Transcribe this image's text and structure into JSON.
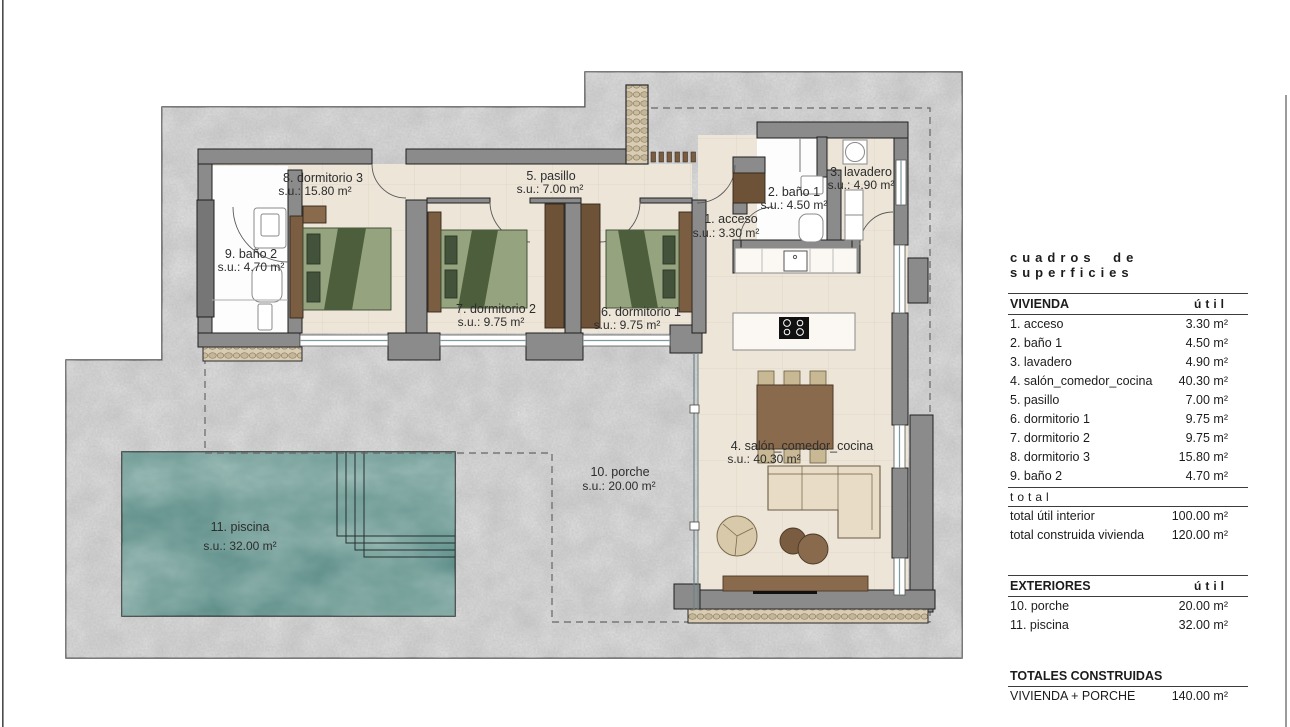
{
  "plan": {
    "labels": [
      {
        "id": "acceso",
        "l1": "1. acceso",
        "l2": "s.u.: 3.30 m²"
      },
      {
        "id": "bano1",
        "l1": "2. baño 1",
        "l2": "s.u.: 4.50 m²"
      },
      {
        "id": "lavadero",
        "l1": "3. lavadero",
        "l2": "s.u.: 4.90 m²"
      },
      {
        "id": "salon",
        "l1": "4. salón_comedor_cocina",
        "l2": "s.u.: 40.30 m²"
      },
      {
        "id": "pasillo",
        "l1": "5. pasillo",
        "l2": "s.u.: 7.00 m²"
      },
      {
        "id": "dormitorio1",
        "l1": "6. dormitorio 1",
        "l2": "s.u.: 9.75 m²"
      },
      {
        "id": "dormitorio2",
        "l1": "7. dormitorio 2",
        "l2": "s.u.: 9.75 m²"
      },
      {
        "id": "dormitorio3",
        "l1": "8. dormitorio 3",
        "l2": "s.u.: 15.80 m²"
      },
      {
        "id": "bano2",
        "l1": "9. baño 2",
        "l2": "s.u.: 4.70 m²"
      },
      {
        "id": "porche",
        "l1": "10. porche",
        "l2": "s.u.: 20.00 m²"
      },
      {
        "id": "piscina",
        "l1": "11. piscina",
        "l2": "s.u.: 32.00 m²"
      }
    ]
  },
  "panel": {
    "title": "cuadros de superficies",
    "vivienda": {
      "header": "VIVIENDA",
      "unit_col": "útil",
      "rows": [
        {
          "label": "1. acceso",
          "value": "3.30 m²"
        },
        {
          "label": "2. baño 1",
          "value": "4.50 m²"
        },
        {
          "label": "3. lavadero",
          "value": "4.90 m²"
        },
        {
          "label": "4. salón_comedor_cocina",
          "value": "40.30 m²"
        },
        {
          "label": "5. pasillo",
          "value": "7.00 m²"
        },
        {
          "label": "6. dormitorio 1",
          "value": "9.75 m²"
        },
        {
          "label": "7. dormitorio 2",
          "value": "9.75 m²"
        },
        {
          "label": "8. dormitorio 3",
          "value": "15.80 m²"
        },
        {
          "label": "9. baño 2",
          "value": "4.70 m²"
        }
      ]
    },
    "total_word": "total",
    "totals": [
      {
        "label": "total útil interior",
        "value": "100.00 m²"
      },
      {
        "label": "total construida vivienda",
        "value": "120.00 m²"
      }
    ],
    "exteriores": {
      "header": "EXTERIORES",
      "unit_col": "útil",
      "rows": [
        {
          "label": "10. porche",
          "value": "20.00 m²"
        },
        {
          "label": "11. piscina",
          "value": "32.00 m²"
        }
      ]
    },
    "totales_construidas": {
      "header": "TOTALES CONSTRUIDAS",
      "rows": [
        {
          "label": "VIVIENDA + PORCHE",
          "value": "140.00 m²"
        }
      ]
    },
    "footnote": "*a efectos de ocupación computan 158.00 m²"
  },
  "colors": {
    "concrete": "#c9c9c9",
    "floor": "#ece5d8",
    "wall": "#8b8b8b",
    "wood_dark": "#6e5238",
    "wood": "#8a6a4c",
    "bed_green": "#95a37e",
    "bed_green_dark": "#4d5e3d",
    "water": "#4e827c",
    "pebble": "#d8cdb4"
  }
}
